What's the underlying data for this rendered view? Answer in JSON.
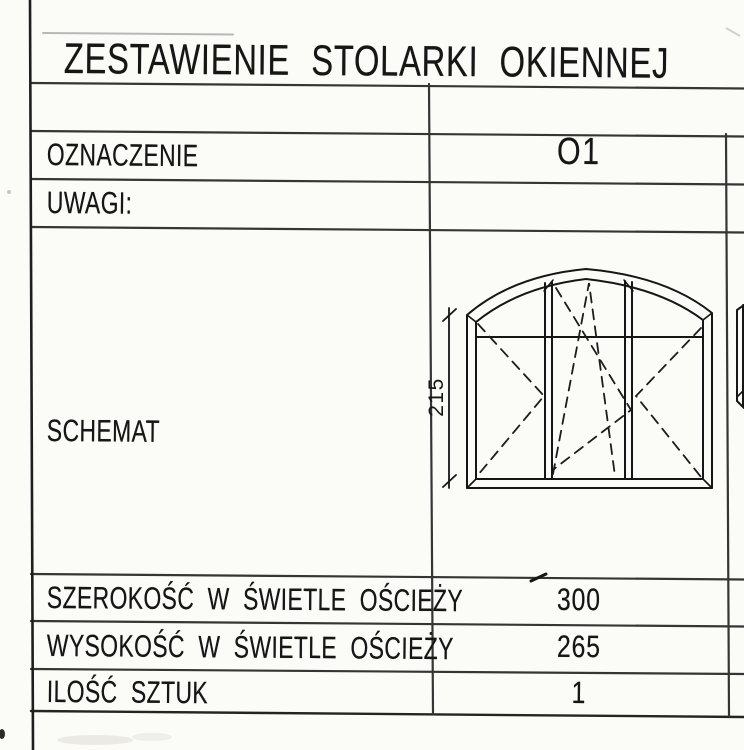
{
  "document": {
    "title": "ZESTAWIENIE STOLARKI OKIENNEJ"
  },
  "table": {
    "rows": [
      {
        "label": "OZNACZENIE",
        "value": "O1"
      },
      {
        "label": "UWAGI:",
        "value": ""
      },
      {
        "label": "SCHEMAT",
        "value": ""
      },
      {
        "label": "SZEROKOŚĆ W ŚWIETLE OŚCIEŻY",
        "value": "300"
      },
      {
        "label": "WYSOKOŚĆ W ŚWIETLE OŚCIEŻY",
        "value": "265"
      },
      {
        "label": "ILOŚĆ SZTUK",
        "value": "1"
      }
    ]
  },
  "schematic": {
    "icon": "arched-three-sash-window-drawing",
    "dimension_label": "215"
  },
  "colors": {
    "ink": "#161616",
    "grid_line": "#353535",
    "faint_line": "#b8b8b8",
    "paper": "#fbfbf8"
  }
}
